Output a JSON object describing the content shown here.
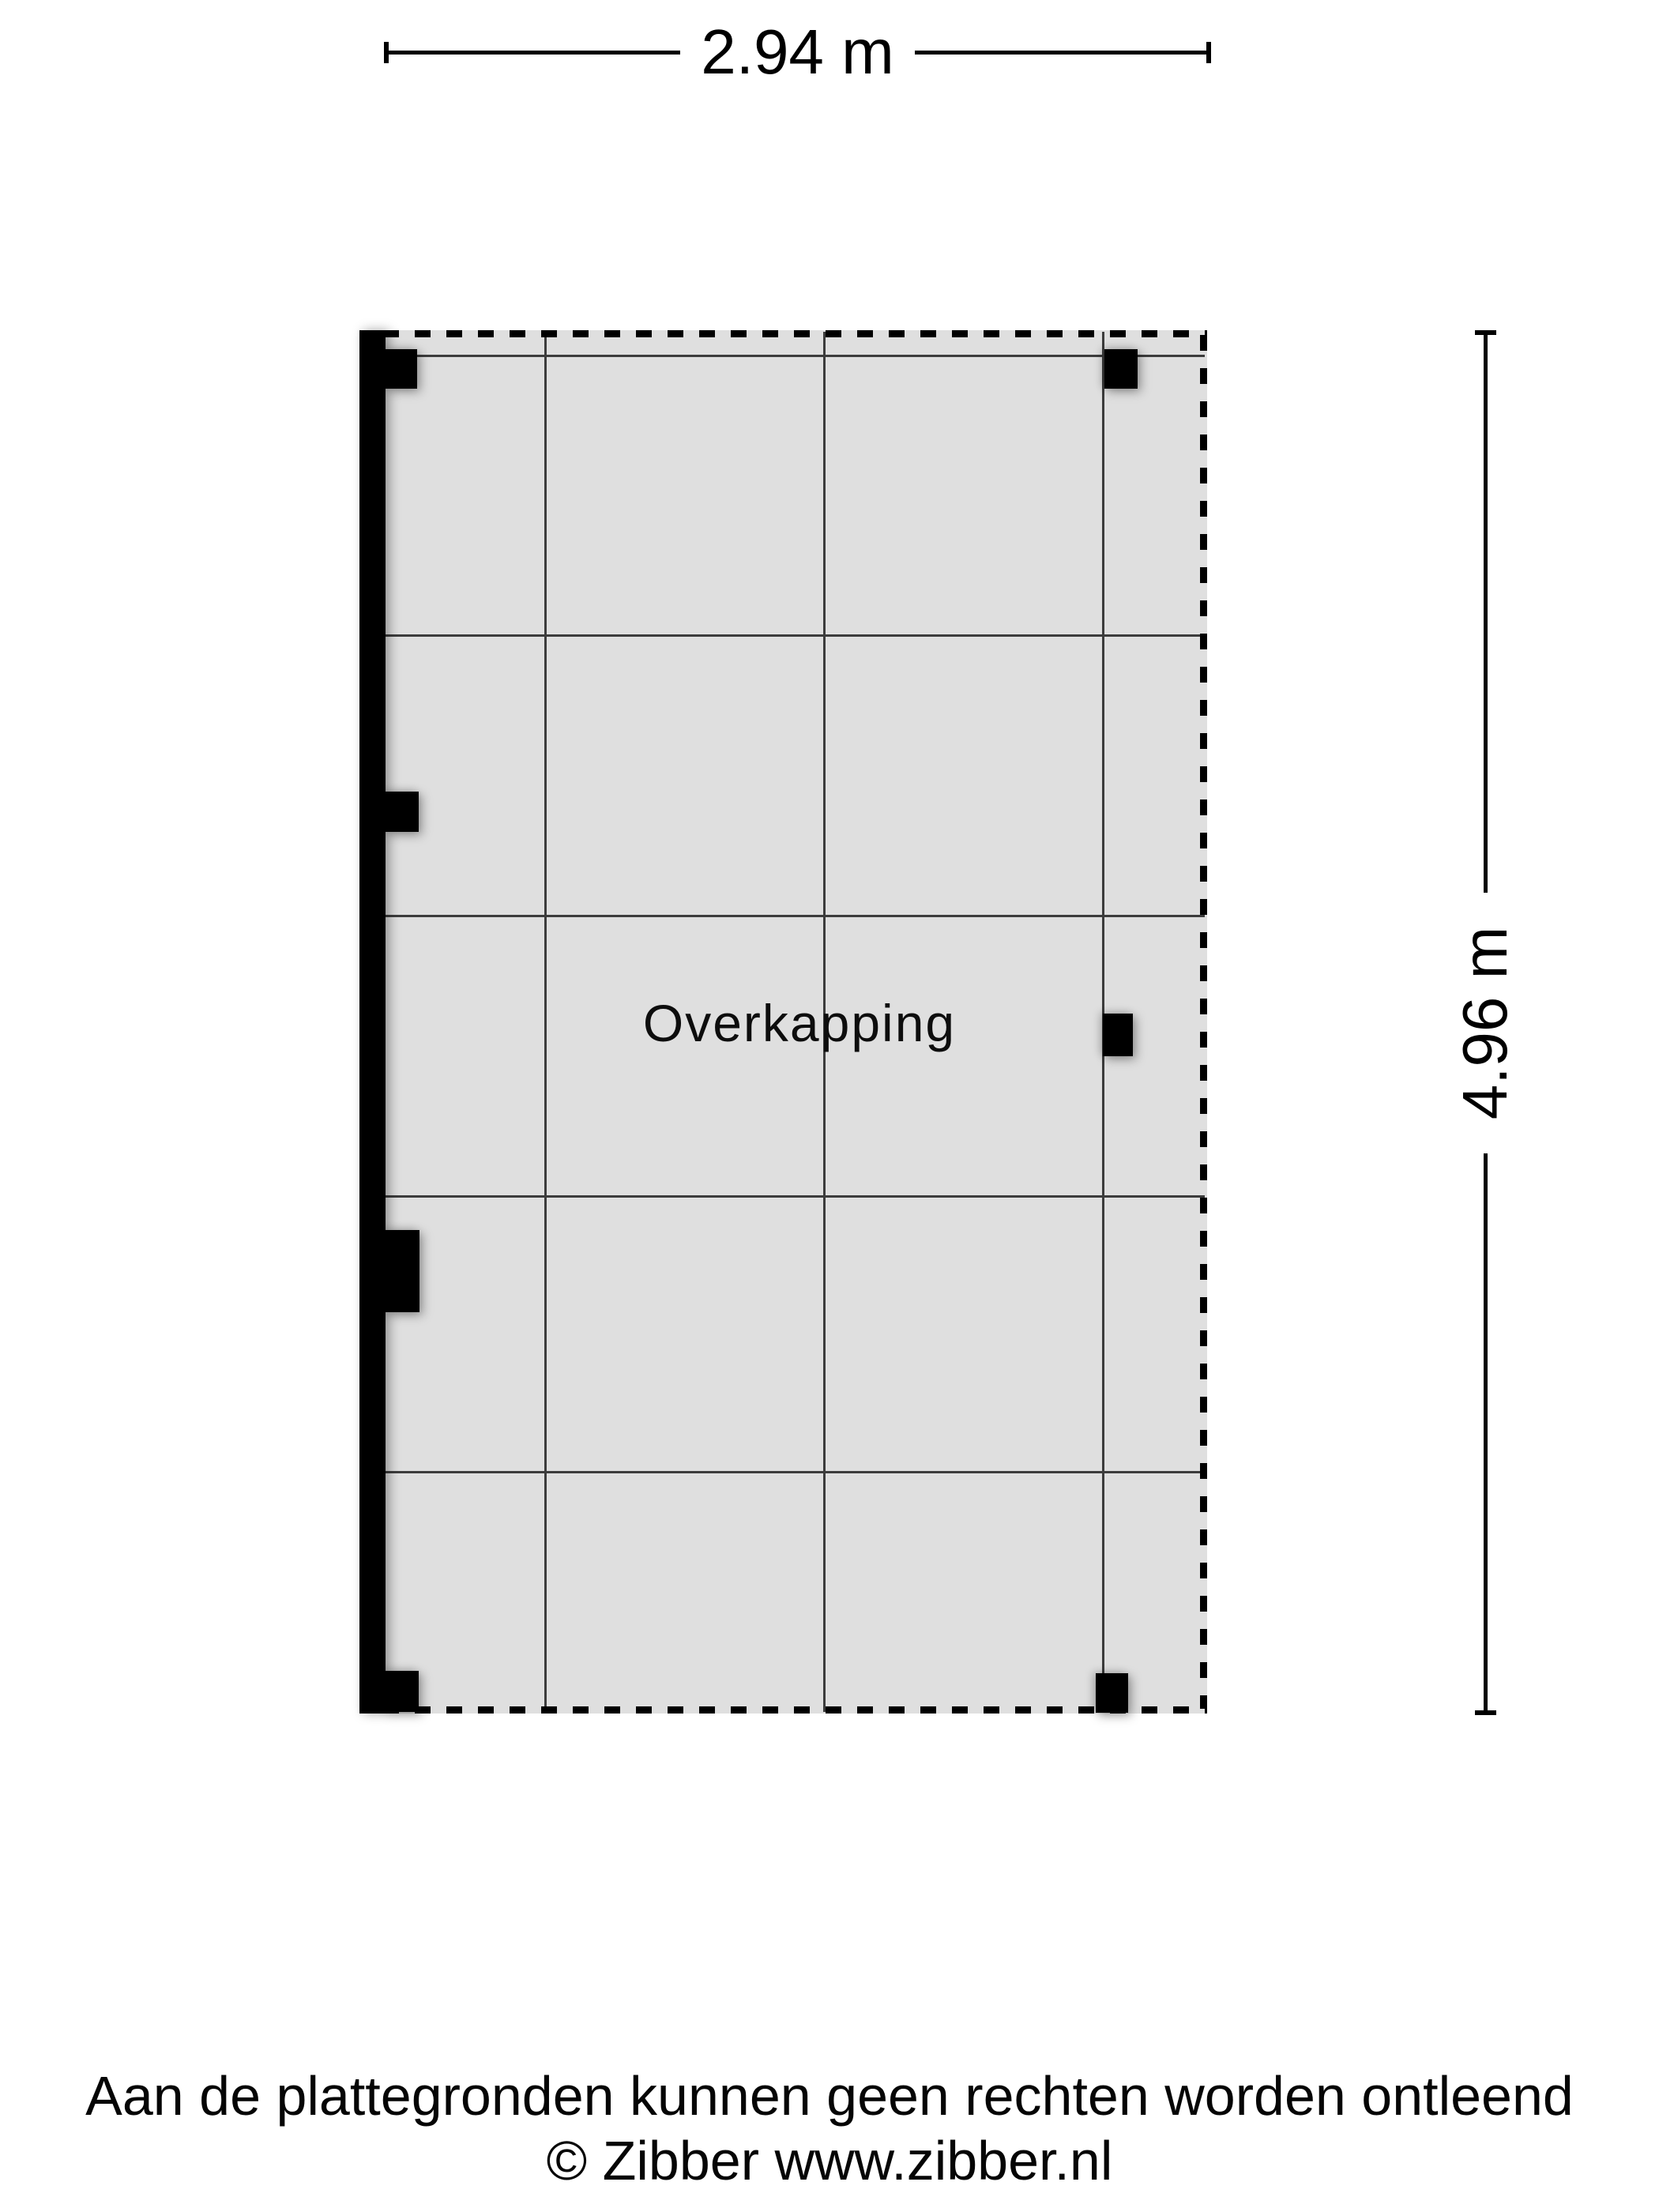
{
  "dimensions": {
    "top": {
      "label": "2.94 m"
    },
    "right": {
      "label": "4.96 m"
    }
  },
  "floorplan": {
    "room_label": "Overkapping"
  },
  "footer": {
    "disclaimer": "Aan de plattegronden kunnen geen rechten worden ontleend",
    "copyright": "© Zibber www.zibber.nl"
  },
  "colors": {
    "background": "#ffffff",
    "floor_fill": "#dfdfdf",
    "grid_line": "#3c3c3c",
    "structure": "#000000"
  }
}
